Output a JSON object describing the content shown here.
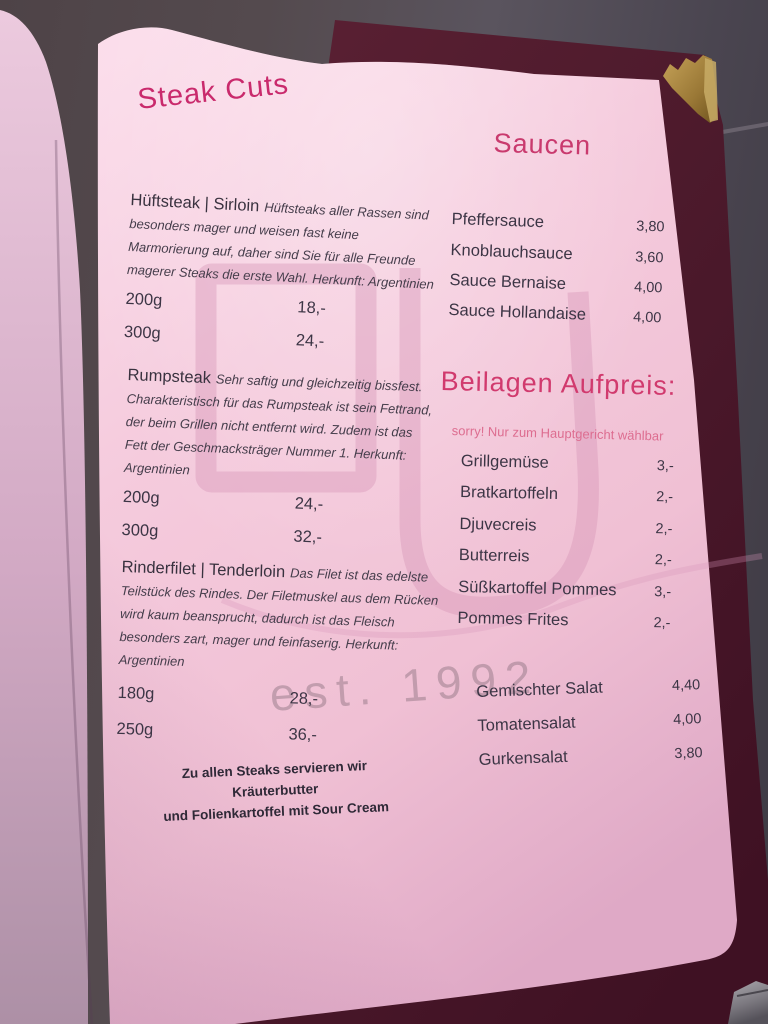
{
  "page": {
    "left_column": {
      "title": "Steak Cuts",
      "sections": [
        {
          "name": "Hüftsteak | Sirloin",
          "desc": "Hüftsteaks aller Rassen sind besonders mager und weisen fast keine Marmorierung auf, daher sind Sie für alle Freunde magerer Steaks die erste Wahl. Herkunft: Argentinien",
          "items": [
            {
              "size": "200g",
              "price": "18,-"
            },
            {
              "size": "300g",
              "price": "24,-"
            }
          ]
        },
        {
          "name": "Rumpsteak",
          "desc": "Sehr saftig und gleichzeitig bissfest. Charakteristisch für das Rumpsteak ist sein Fettrand, der beim Grillen nicht entfernt wird. Zudem ist das Fett der Geschmacksträger Nummer 1. Herkunft: Argentinien",
          "items": [
            {
              "size": "200g",
              "price": "24,-"
            },
            {
              "size": "300g",
              "price": "32,-"
            }
          ]
        },
        {
          "name": "Rinderfilet | Tenderloin",
          "desc": "Das Filet ist das edelste Teilstück des Rindes. Der Filetmuskel aus dem Rücken wird kaum beansprucht, dadurch ist das Fleisch besonders zart, mager und feinfaserig. Herkunft: Argentinien",
          "items": [
            {
              "size": "180g",
              "price": "28,-"
            },
            {
              "size": "250g",
              "price": "36,-"
            }
          ]
        }
      ],
      "footnote": [
        "Zu allen Steaks servieren wir Kräuterbutter",
        "und Folienkartoffel mit Sour Cream"
      ]
    },
    "right_column": {
      "saucen_title": "Saucen",
      "saucen": [
        {
          "name": "Pfeffersauce",
          "price": "3,80"
        },
        {
          "name": "Knoblauchsauce",
          "price": "3,60"
        },
        {
          "name": "Sauce Bernaise",
          "price": "4,00"
        },
        {
          "name": "Sauce Hollandaise",
          "price": "4,00"
        }
      ],
      "beilagen_title": "Beilagen Aufpreis:",
      "beilagen_note": "sorry! Nur zum Hauptgericht wählbar",
      "beilagen": [
        {
          "name": "Grillgemüse",
          "price": "3,-"
        },
        {
          "name": "Bratkartoffeln",
          "price": "2,-"
        },
        {
          "name": "Djuvecreis",
          "price": "2,-"
        },
        {
          "name": "Butterreis",
          "price": "2,-"
        },
        {
          "name": "Süßkartoffel Pommes",
          "price": "3,-"
        },
        {
          "name": "Pommes Frites",
          "price": "2,-"
        }
      ],
      "salate": [
        {
          "name": "Gemischter Salat",
          "price": "4,40"
        },
        {
          "name": "Tomatensalat",
          "price": "4,00"
        },
        {
          "name": "Gurkensalat",
          "price": "3,80"
        }
      ]
    },
    "watermark_text": "est. 1992",
    "colors": {
      "accent": "#c92a6c",
      "note_pink": "#dd6d90",
      "body_text": "#3c3545",
      "cover_maroon": "#4d1a2c",
      "paper_pink": "#f3c6da",
      "gold_corner": "#a8833f"
    }
  }
}
